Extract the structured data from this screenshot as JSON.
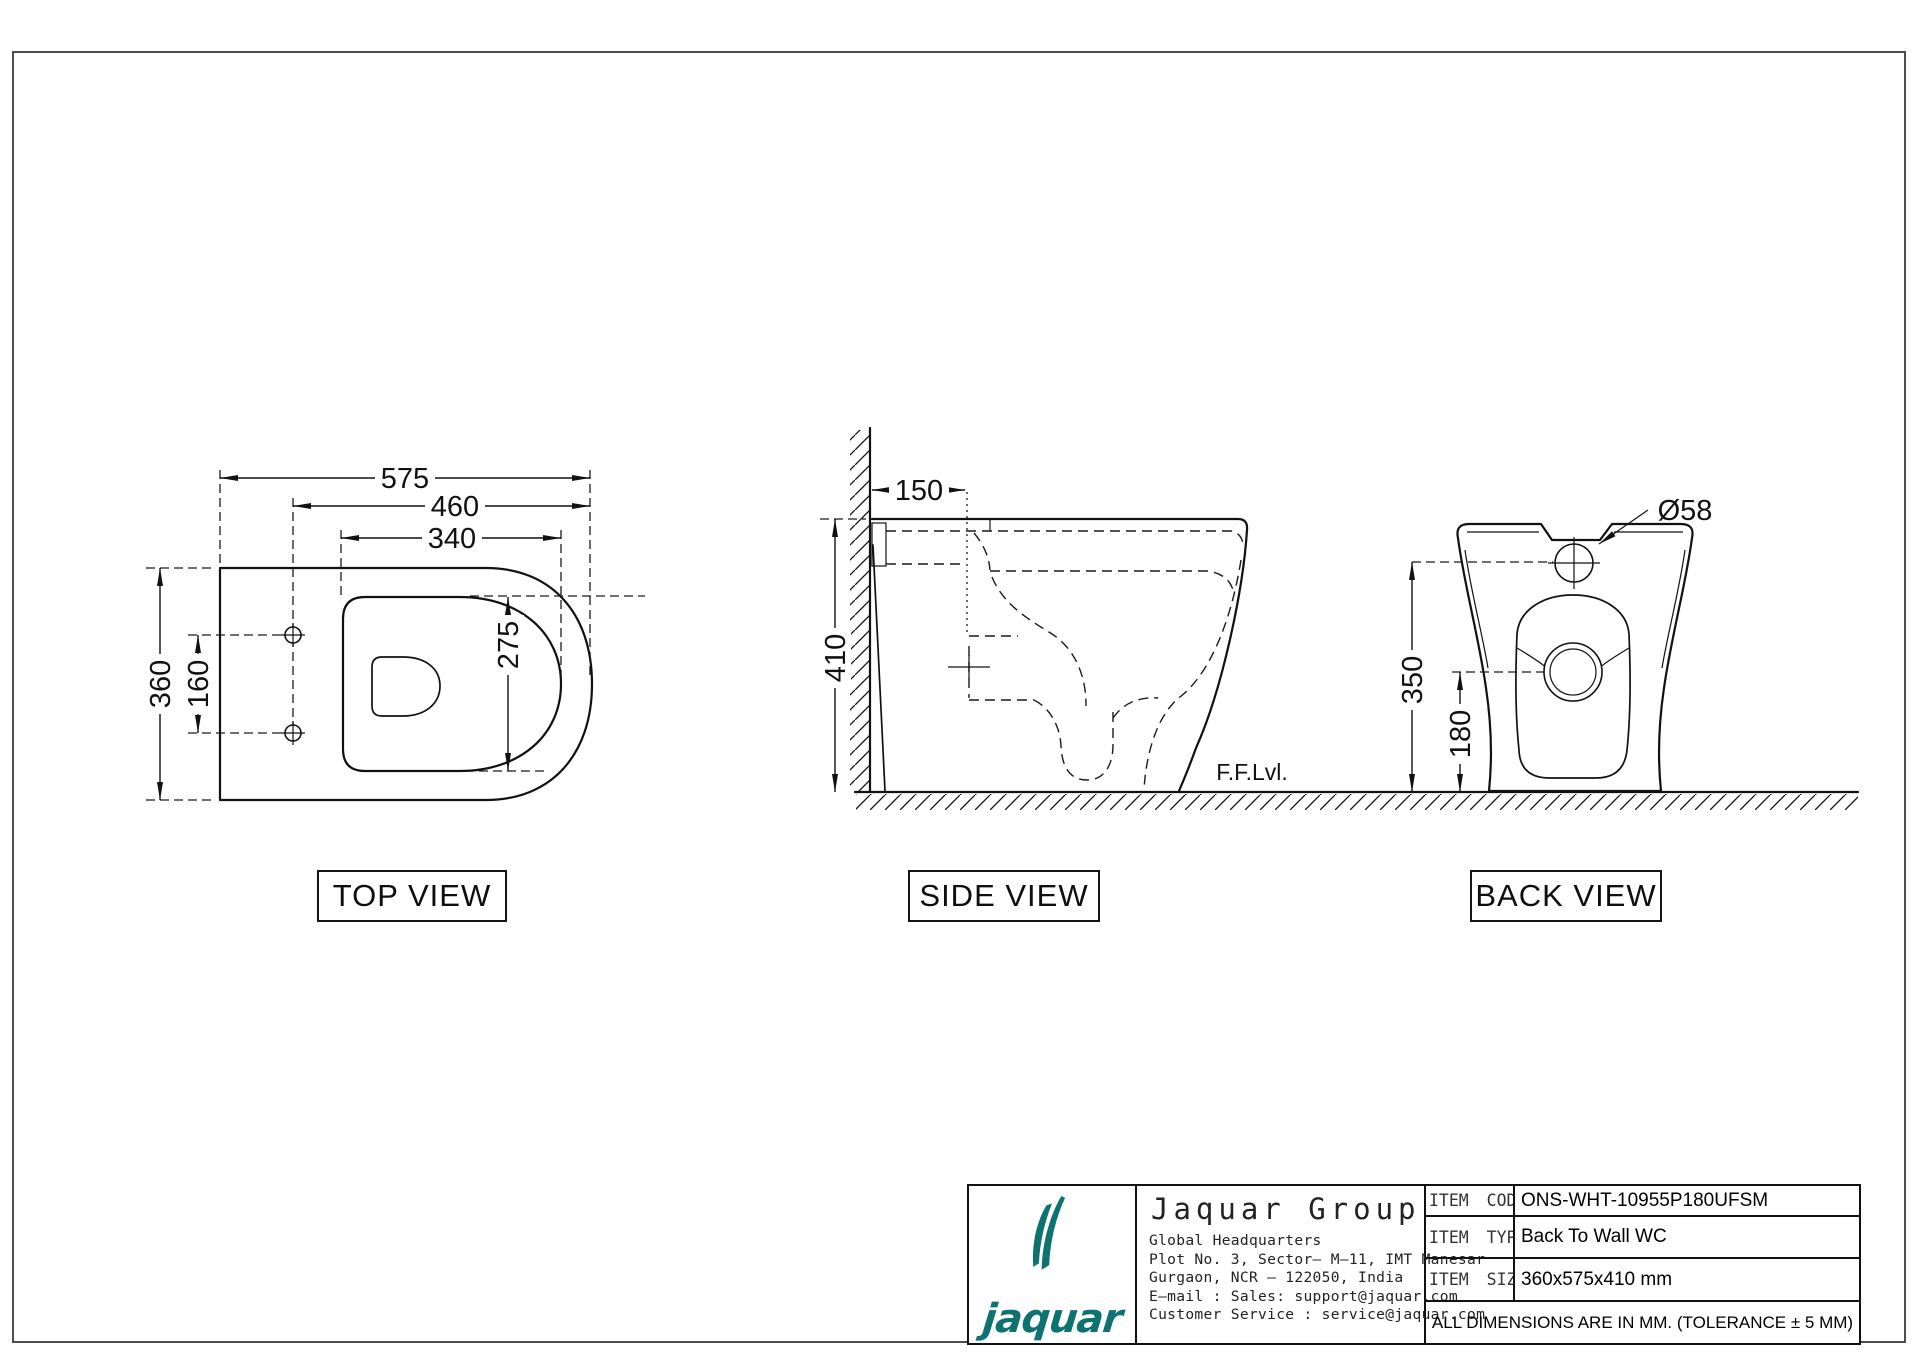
{
  "views": {
    "top": {
      "label": "TOP VIEW",
      "dims": {
        "total_depth": "575",
        "seat_depth": "460",
        "seat_opening_length": "340",
        "body_width": "360",
        "fixing_hole_spacing": "160",
        "seat_opening_width": "275"
      }
    },
    "side": {
      "label": "SIDE VIEW",
      "dims": {
        "outlet_from_wall": "150",
        "body_height": "410"
      },
      "floor_label": "F.F.Lvl."
    },
    "back": {
      "label": "BACK VIEW",
      "dims": {
        "inlet_diameter": "Ø58",
        "inlet_height": "350",
        "outlet_height": "180"
      }
    }
  },
  "title_block": {
    "logo_text": "jaquar",
    "company": "Jaquar Group",
    "address_lines": [
      "Global Headquarters",
      "Plot No. 3, Sector– M–11, IMT Manesar",
      "Gurgaon, NCR – 122050, India",
      "E–mail : Sales: support@jaquar.com",
      "Customer Service : service@jaquar.com"
    ],
    "items": [
      {
        "label": "ITEM CODE",
        "value": "ONS-WHT-10955P180UFSM"
      },
      {
        "label": "ITEM TYPE",
        "value": "Back To Wall WC"
      },
      {
        "label": "ITEM SIZE",
        "value": "360x575x410 mm"
      }
    ],
    "note": "ALL DIMENSIONS ARE IN MM. (TOLERANCE ± 5 MM)",
    "brand_color": "#0d7270"
  }
}
